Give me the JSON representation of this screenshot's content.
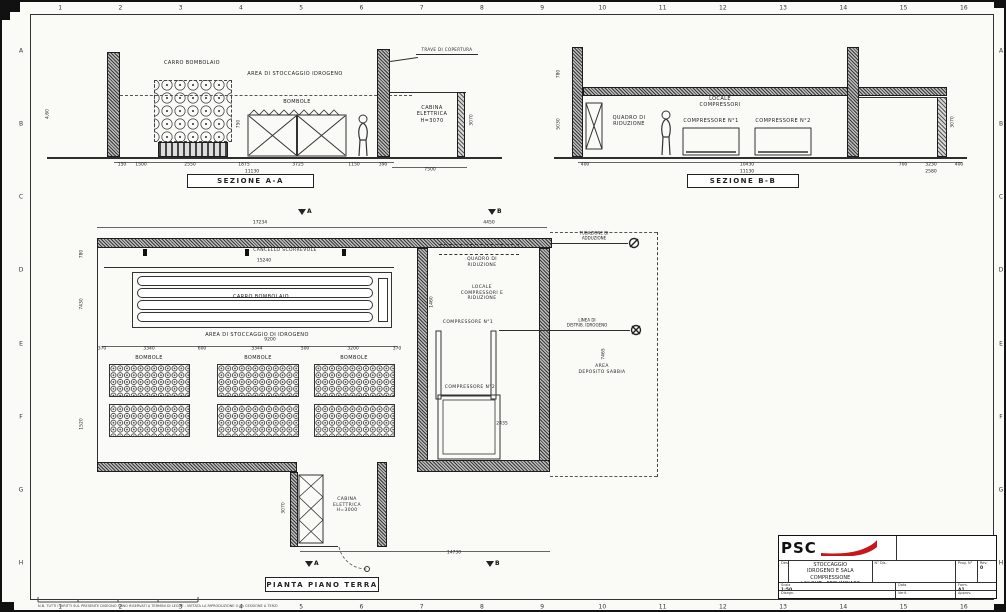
{
  "sheet": {
    "paper_color": "#fafaf7",
    "line_color": "#2e2e2e",
    "accent_red": "#c8161d"
  },
  "grid": {
    "top_numbers": [
      "1",
      "2",
      "3",
      "4",
      "5",
      "6",
      "7",
      "8",
      "9",
      "10",
      "11",
      "12",
      "13",
      "14",
      "15",
      "16"
    ],
    "side_letters": [
      "A",
      "B",
      "C",
      "D",
      "E",
      "F",
      "G",
      "H"
    ]
  },
  "section_aa": {
    "title": "SEZIONE A-A",
    "labels": {
      "carro": "CARRO BOMBOLAIO",
      "area": "AREA DI STOCCAGGIO IDROGENO",
      "bombole": "BOMBOLE",
      "cabina": "CABINA\nELETTRICA\nH=3070",
      "trave": "TRAVE DI COPERTURA"
    },
    "dims": [
      {
        "x": 120,
        "y": 163,
        "t": "150"
      },
      {
        "x": 139,
        "y": 163,
        "t": "1500"
      },
      {
        "x": 188,
        "y": 163,
        "t": "2550"
      },
      {
        "x": 242,
        "y": 163,
        "t": "1875"
      },
      {
        "x": 296,
        "y": 163,
        "t": "3725"
      },
      {
        "x": 352,
        "y": 163,
        "t": "1150"
      },
      {
        "x": 381,
        "y": 163,
        "t": "390"
      },
      {
        "x": 250,
        "y": 170,
        "t": "11130"
      },
      {
        "x": 428,
        "y": 168,
        "t": "7500"
      },
      {
        "x": 46,
        "y": 112,
        "t": "4,60",
        "r": 1
      },
      {
        "x": 237,
        "y": 122,
        "t": "750",
        "r": 1
      },
      {
        "x": 470,
        "y": 118,
        "t": "3070",
        "r": 1
      }
    ]
  },
  "section_bb": {
    "title": "SEZIONE B-B",
    "labels": {
      "locale": "LOCALE\nCOMPRESSORI",
      "quadro": "QUADRO DI\nRIDUZIONE",
      "comp1": "COMPRESSORE N°1",
      "comp2": "COMPRESSORE N°2"
    },
    "dims": [
      {
        "x": 583,
        "y": 163,
        "t": "400"
      },
      {
        "x": 745,
        "y": 163,
        "t": "10430"
      },
      {
        "x": 745,
        "y": 170,
        "t": "11130"
      },
      {
        "x": 901,
        "y": 163,
        "t": "700"
      },
      {
        "x": 929,
        "y": 163,
        "t": "3230"
      },
      {
        "x": 929,
        "y": 170,
        "t": "2580"
      },
      {
        "x": 957,
        "y": 163,
        "t": "400"
      },
      {
        "x": 557,
        "y": 72,
        "t": "780",
        "r": 1
      },
      {
        "x": 557,
        "y": 122,
        "t": "5030",
        "r": 1
      },
      {
        "x": 951,
        "y": 120,
        "t": "3070",
        "r": 1
      }
    ]
  },
  "plan": {
    "title": "PIANTA PIANO TERRA",
    "labels": {
      "cancello": "CANCELLO SCORREVOLE",
      "carro": "CARRO BOMBOLAIO",
      "area": "AREA DI STOCCAGGIO DI IDROGENO",
      "bombole": "BOMBOLE",
      "quadro": "QUADRO DI\nRIDUZIONE",
      "locale": "LOCALE\nCOMPRESSORI E\nRIDUZIONE",
      "comp1": "COMPRESSORE N°1",
      "comp2": "COMPRESSORE N°2",
      "cabina": "CABINA\nELETTRICA\nH=3000",
      "sabbia": "AREA\nDEPOSITO SABBIA",
      "leader1": "TUBAZIONE DI\nADDUZIONE",
      "leader2": "LINEA DI\nDISTRIB. IDROGENO",
      "marker_a": "A",
      "marker_b": "B"
    },
    "dims": [
      {
        "x": 258,
        "y": 221,
        "t": "17234"
      },
      {
        "x": 487,
        "y": 221,
        "t": "4450"
      },
      {
        "x": 262,
        "y": 259,
        "t": "15240"
      },
      {
        "x": 268,
        "y": 338,
        "t": "9200"
      },
      {
        "x": 100,
        "y": 347,
        "t": "370"
      },
      {
        "x": 147,
        "y": 347,
        "t": "3340"
      },
      {
        "x": 200,
        "y": 347,
        "t": "600"
      },
      {
        "x": 255,
        "y": 347,
        "t": "3344"
      },
      {
        "x": 303,
        "y": 347,
        "t": "500"
      },
      {
        "x": 351,
        "y": 347,
        "t": "3200"
      },
      {
        "x": 395,
        "y": 347,
        "t": "370"
      },
      {
        "x": 80,
        "y": 252,
        "t": "780",
        "r": 1
      },
      {
        "x": 80,
        "y": 302,
        "t": "7430",
        "r": 1
      },
      {
        "x": 80,
        "y": 422,
        "t": "1520",
        "r": 1
      },
      {
        "x": 452,
        "y": 551,
        "t": "14730"
      },
      {
        "x": 282,
        "y": 506,
        "t": "3070",
        "r": 1
      },
      {
        "x": 430,
        "y": 300,
        "t": "1460",
        "r": 1
      },
      {
        "x": 500,
        "y": 422,
        "t": "2435"
      },
      {
        "x": 602,
        "y": 352,
        "t": "7465",
        "r": 1
      }
    ]
  },
  "title_block": {
    "logo_text": "PSC",
    "desc_label": "Descr.",
    "title_text": "LOCALI - IMPIANTO DI STOCCAGGIO\nIDROGENO E SALA COMPRESSIONE\nLAY-OUT - PRELIMINARE",
    "fields": [
      {
        "l": "N° Dis.",
        "v": ""
      },
      {
        "l": "Prog. N°",
        "v": ""
      },
      {
        "l": "Rev.",
        "v": "0"
      },
      {
        "l": "Scala",
        "v": "1:50"
      },
      {
        "l": "Data",
        "v": ""
      },
      {
        "l": "Form.",
        "v": "A1"
      },
      {
        "l": "Disegn.",
        "v": ""
      },
      {
        "l": "Verif.",
        "v": ""
      },
      {
        "l": "Approv.",
        "v": ""
      }
    ]
  },
  "footer_note": "N.B. TUTTI I DIRITTI SUL PRESENTE DISEGNO SONO RISERVATI A TERMINI DI LEGGE - VIETATA LA RIPRODUZIONE O LA CESSIONE A TERZI"
}
